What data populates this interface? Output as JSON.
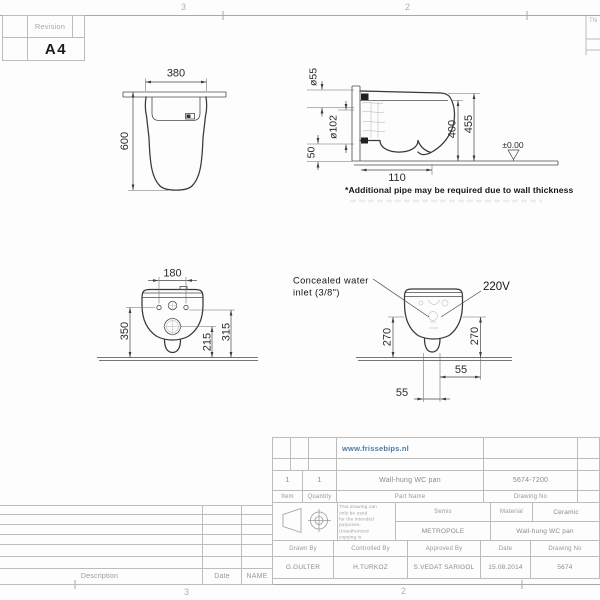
{
  "frame": {
    "grid_top_left": "3",
    "grid_top_right": "2",
    "grid_bottom_left": "3",
    "grid_bottom_right": "2",
    "corner_fragment": "Thi"
  },
  "revision_box": {
    "label": "Revision",
    "size": "A4"
  },
  "views": {
    "plan": {
      "width": "380",
      "depth": "600"
    },
    "side": {
      "dia_small": "ø55",
      "dia_large": "ø102",
      "h50": "50",
      "w110": "110",
      "h400": "400",
      "h455": "455",
      "datum": "±0.00",
      "note": "*Additional pipe may be required due to wall thickness"
    },
    "front": {
      "w180": "180",
      "h350": "350",
      "h215": "215",
      "h315": "315"
    },
    "rear": {
      "inlet1": "Concealed water",
      "inlet2": "inlet (3/8\")",
      "power": "220V",
      "h270l": "270",
      "h270r": "270",
      "w55r": "55",
      "w55b": "55"
    }
  },
  "title_block": {
    "website": "www.frissebips.nl",
    "item_value": "1",
    "qty_value": "1",
    "part_name_value": "Wall-hung WC pan",
    "drawing_no_value": "5674-7200",
    "item_label": "Item",
    "qty_label": "Quantity",
    "part_name_label": "Part Name",
    "drawing_no_label": "Drawing No",
    "disclaimer": "This drawing can only be used\nfor the intended purposes.\nUnauthorized copying is\nstrictly prohibited.",
    "semis_label": "Semis",
    "series_value": "METROPOLE",
    "material_label": "Material",
    "material_value": "Ceramic",
    "product_value": "Wall-hung WC pan",
    "drawn_by_label": "Drawn By",
    "drawn_by": "G.GULTER",
    "controlled_by_label": "Controlled By",
    "controlled_by": "H.TURKOZ",
    "approved_by_label": "Approved By",
    "approved_by": "S.VEDAT SARIGOL",
    "date_label": "Date",
    "date": "15.08.2014",
    "drawing_no2_label": "Drawing No",
    "drawing_no2": "5674"
  },
  "revision_table": {
    "description": "Description",
    "date": "Date",
    "name": "NAME"
  }
}
